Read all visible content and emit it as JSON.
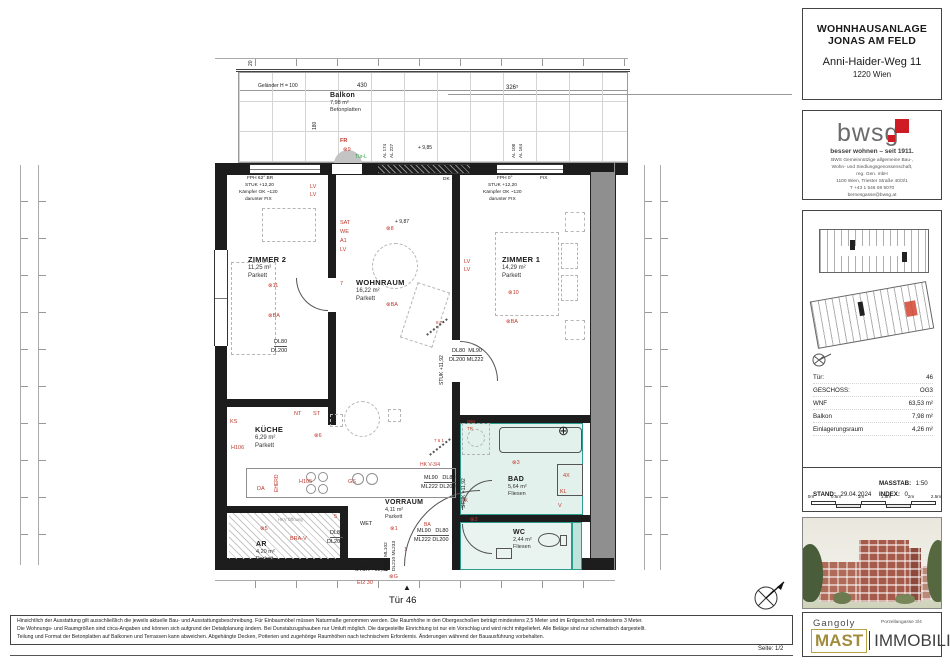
{
  "sheet_title": "Wohnungsplan Tür 46",
  "sidebar": {
    "header": {
      "line1": "WOHNHAUSANLAGE",
      "line2": "JONAS AM FELD",
      "street": "Anni-Haider-Weg 11",
      "city": "1220 Wien"
    },
    "bwsg": {
      "logo_text": "bwsg",
      "tagline": "besser wohnen – seit 1911.",
      "address_lines": [
        "BWS Gemeinnützige allgemeine Bau-,",
        "Wohn- und Siedlungsgenossenschaft,",
        "reg. Gen. mbH",
        "1100 Wien, Triester Straße 40/3/1",
        "T +43 1 546 08 5070",
        "bernesgasse@bwsg.at"
      ]
    },
    "info_table": {
      "rows": [
        {
          "label": "Tür:",
          "value": "46"
        },
        {
          "label": "GESCHOSS:",
          "value": "OG3"
        },
        {
          "label": "WNF",
          "value": "63,53 m²"
        },
        {
          "label": "Balkon",
          "value": "7,98 m²"
        },
        {
          "label": "Einlagerungsraum",
          "value": "4,26 m²"
        }
      ]
    },
    "meta": {
      "masstab_label": "MASSTAB:",
      "masstab_value": "1:50",
      "stand_label": "STAND:",
      "stand_value": "29.04.2024",
      "index_label": "INDEX:",
      "index_value": "0"
    },
    "scalebar": {
      "labels": [
        "0m",
        "0.5m",
        "1m",
        "1.5m",
        "2m",
        "2.5m"
      ]
    },
    "brand": {
      "architect": "Gangoly",
      "address": "Porzellangasse 3/4",
      "mast": "MAST",
      "immobilien": "IMMOBILIEN"
    }
  },
  "footer": {
    "page_label": "Seite: 1/2",
    "disclaimer_lines": [
      "Hinsichtlich der Ausstattung gilt ausschließlich die jeweils aktuelle Bau- und Ausstattungsbeschreibung. Für Einbaumöbel müssen Naturmaße genommen werden. Die Raumhöhe in den Obergeschoßen beträgt mindestens 2,5 Meter und im Erdgeschoß mindestens 3 Meter.",
      "Die Wohnungs- und Raumgrößen sind circa-Angaben und können sich aufgrund der Detailplanung ändern. Bei Dunstabzugshauben nur Umluft möglich. Die dargestellte Einrichtung ist nur ein Vorschlag und wird nicht mitgeliefert. Alle Beläge sind nur schematisch dargestellt.",
      "Teilung und Format der Betonplatten auf Balkonen und Terrassen kann abweichen. Abgehängte Decken, Potterien und zugehörige Raumhöhen nach technischem Erfordernis. Änderungen während der Bauausführung vorbehalten."
    ]
  },
  "plan": {
    "door_label": "Tür 46",
    "colors": {
      "red": "#c0392b",
      "green": "#2f9e44",
      "black": "#1a1a1a",
      "gray": "#8a8a8a",
      "bad_fill": "#e3f1ed",
      "bad_border": "#2e9c8c"
    },
    "rooms": {
      "balkon": {
        "name": "Balkon",
        "area": "7,98 m²",
        "floor": "Betonplatten"
      },
      "zimmer2": {
        "name": "ZIMMER 2",
        "area": "11,25 m²",
        "floor": "Parkett"
      },
      "wohnraum": {
        "name": "WOHNRAUM",
        "area": "16,22 m²",
        "floor": "Parkett"
      },
      "zimmer1": {
        "name": "ZIMMER 1",
        "area": "14,29 m²",
        "floor": "Parkett"
      },
      "kueche": {
        "name": "KÜCHE",
        "area": "6,29 m²",
        "floor": "Parkett"
      },
      "bad": {
        "name": "BAD",
        "area": "5,64 m²",
        "floor": "Fliesen"
      },
      "wc": {
        "name": "WC",
        "area": "2,44 m²",
        "floor": "Fliesen"
      },
      "vorraum": {
        "name": "VORRAUM",
        "area": "4,11 m²",
        "floor": "Parkett"
      },
      "ar": {
        "name": "AR",
        "area": "4,20 m²",
        "floor": "Parkett"
      }
    },
    "annotations": [
      {
        "t": "Geländer H = 100",
        "x": 258,
        "y": 84,
        "s": 5
      },
      {
        "t": "430",
        "x": 357,
        "y": 83,
        "s": 6
      },
      {
        "t": "326⁵",
        "x": 506,
        "y": 85,
        "s": 6
      },
      {
        "t": "20",
        "x": 249,
        "y": 66,
        "r": -90,
        "s": 5
      },
      {
        "t": "180",
        "x": 313,
        "y": 130,
        "r": -90,
        "s": 5
      },
      {
        "t": "+ 9,85",
        "x": 418,
        "y": 146,
        "s": 5
      },
      {
        "t": "+ 9,87",
        "x": 395,
        "y": 220,
        "s": 5
      },
      {
        "t": "AL 174",
        "x": 383,
        "y": 158,
        "r": -90,
        "s": 4.5
      },
      {
        "t": "AL 227",
        "x": 390,
        "y": 158,
        "r": -90,
        "s": 4.5
      },
      {
        "t": "AL 108",
        "x": 512,
        "y": 158,
        "r": -90,
        "s": 4.5
      },
      {
        "t": "AL 164",
        "x": 519,
        "y": 158,
        "r": -90,
        "s": 4.5
      },
      {
        "t": "FPH 62° BR",
        "x": 247,
        "y": 177,
        "s": 4.8
      },
      {
        "t": "STUK +12,20",
        "x": 245,
        "y": 184,
        "s": 4.8
      },
      {
        "t": "Kämpfer OK ~120",
        "x": 239,
        "y": 191,
        "s": 4.8
      },
      {
        "t": "darunter FIX",
        "x": 245,
        "y": 198,
        "s": 4.8
      },
      {
        "t": "DK",
        "x": 443,
        "y": 178,
        "s": 4.8
      },
      {
        "t": "FPH 0°",
        "x": 497,
        "y": 177,
        "s": 4.8
      },
      {
        "t": "FIX",
        "x": 540,
        "y": 177,
        "s": 4.8
      },
      {
        "t": "STUK +12,20",
        "x": 488,
        "y": 184,
        "s": 4.8
      },
      {
        "t": "Kämpfer OK ~120",
        "x": 483,
        "y": 191,
        "s": 4.8
      },
      {
        "t": "darunter FIX",
        "x": 489,
        "y": 198,
        "s": 4.8
      },
      {
        "t": "DL80",
        "x": 274,
        "y": 340,
        "s": 5.5,
        "u": 1
      },
      {
        "t": "DL200",
        "x": 271,
        "y": 349,
        "s": 5.5
      },
      {
        "t": "DL80  ML90",
        "x": 452,
        "y": 349,
        "s": 5.5,
        "u": 1
      },
      {
        "t": "DL200 ML222",
        "x": 449,
        "y": 358,
        "s": 5.5
      },
      {
        "t": "ML90   DL80",
        "x": 424,
        "y": 476,
        "s": 5.5,
        "u": 1
      },
      {
        "t": "ML222 DL200",
        "x": 421,
        "y": 485,
        "s": 5.5
      },
      {
        "t": "ML90   DL80",
        "x": 417,
        "y": 529,
        "s": 5.5,
        "u": 1
      },
      {
        "t": "ML222 DL200",
        "x": 414,
        "y": 538,
        "s": 5.5
      },
      {
        "t": "DL80",
        "x": 330,
        "y": 531,
        "s": 5.5,
        "u": 1
      },
      {
        "t": "DL200",
        "x": 327,
        "y": 540,
        "s": 5.5
      },
      {
        "t": "WET",
        "x": 360,
        "y": 522,
        "s": 5.5
      },
      {
        "t": "HKV Öffnung",
        "x": 278,
        "y": 518,
        "s": 4.2,
        "c": "gray"
      },
      {
        "t": "STUK +11,92",
        "x": 440,
        "y": 385,
        "r": -90,
        "s": 5
      },
      {
        "t": "STUK +11,92",
        "x": 462,
        "y": 508,
        "r": -90,
        "s": 5
      },
      {
        "t": "STUK +12,03",
        "x": 355,
        "y": 568,
        "s": 5.5
      },
      {
        "t": "DL90  ML102",
        "x": 385,
        "y": 571,
        "r": -90,
        "s": 4.8
      },
      {
        "t": "DL210 ML233",
        "x": 393,
        "y": 571,
        "r": -90,
        "s": 4.8
      },
      {
        "t": "▲",
        "x": 403,
        "y": 584,
        "s": 8
      },
      {
        "t": "⊕",
        "x": 558,
        "y": 424,
        "s": 13
      },
      {
        "t": "FR",
        "x": 340,
        "y": 139,
        "c": "red",
        "s": 5.5,
        "w": 1
      },
      {
        "t": "⊗9",
        "x": 343,
        "y": 148,
        "c": "red",
        "s": 5.5
      },
      {
        "t": "Tür-L",
        "x": 355,
        "y": 155,
        "c": "green",
        "s": 5
      },
      {
        "t": "LV",
        "x": 310,
        "y": 185,
        "c": "red",
        "s": 5.5
      },
      {
        "t": "LV",
        "x": 310,
        "y": 193,
        "c": "red",
        "s": 5.5
      },
      {
        "t": "SAT",
        "x": 340,
        "y": 221,
        "c": "red",
        "s": 5.5
      },
      {
        "t": "WE",
        "x": 340,
        "y": 230,
        "c": "red",
        "s": 5.5
      },
      {
        "t": "A1",
        "x": 340,
        "y": 239,
        "c": "red",
        "s": 5.5
      },
      {
        "t": "LV",
        "x": 340,
        "y": 248,
        "c": "red",
        "s": 5.5
      },
      {
        "t": "⊗11",
        "x": 268,
        "y": 284,
        "c": "red",
        "s": 5.5
      },
      {
        "t": "⊗BA",
        "x": 268,
        "y": 314,
        "c": "red",
        "s": 5.5
      },
      {
        "t": "7",
        "x": 340,
        "y": 282,
        "c": "red",
        "s": 5.5
      },
      {
        "t": "⊗8",
        "x": 386,
        "y": 227,
        "c": "red",
        "s": 5.5
      },
      {
        "t": "⊗BA",
        "x": 386,
        "y": 303,
        "c": "red",
        "s": 5.5
      },
      {
        "t": "LV",
        "x": 464,
        "y": 260,
        "c": "red",
        "s": 5.5
      },
      {
        "t": "LV",
        "x": 464,
        "y": 268,
        "c": "red",
        "s": 5.5
      },
      {
        "t": "⊗10",
        "x": 508,
        "y": 291,
        "c": "red",
        "s": 5.5
      },
      {
        "t": "⊗BA",
        "x": 506,
        "y": 320,
        "c": "red",
        "s": 5.5
      },
      {
        "t": "NT",
        "x": 294,
        "y": 412,
        "c": "red",
        "s": 5.5
      },
      {
        "t": "ST",
        "x": 313,
        "y": 412,
        "c": "red",
        "s": 5.5
      },
      {
        "t": "KS",
        "x": 230,
        "y": 420,
        "c": "red",
        "s": 5.5
      },
      {
        "t": "H106",
        "x": 231,
        "y": 446,
        "c": "red",
        "s": 5.5
      },
      {
        "t": "EHERD",
        "x": 275,
        "y": 492,
        "r": -90,
        "c": "red",
        "s": 5
      },
      {
        "t": "DA",
        "x": 257,
        "y": 487,
        "c": "red",
        "s": 5.5
      },
      {
        "t": "H105",
        "x": 299,
        "y": 480,
        "c": "red",
        "s": 5.5
      },
      {
        "t": "GS",
        "x": 348,
        "y": 480,
        "c": "red",
        "s": 5.5
      },
      {
        "t": "⊗6",
        "x": 314,
        "y": 434,
        "c": "red",
        "s": 5.5
      },
      {
        "t": "BRA-V",
        "x": 290,
        "y": 537,
        "c": "red",
        "s": 5.5
      },
      {
        "t": "⊗5",
        "x": 260,
        "y": 527,
        "c": "red",
        "s": 5.5
      },
      {
        "t": "5",
        "x": 334,
        "y": 515,
        "c": "red",
        "s": 5.5
      },
      {
        "t": "HK V-3/4",
        "x": 420,
        "y": 463,
        "c": "red",
        "s": 5
      },
      {
        "t": "7 6 1",
        "x": 434,
        "y": 439,
        "c": "red",
        "s": 4.5
      },
      {
        "t": "8 7",
        "x": 436,
        "y": 321,
        "c": "red",
        "s": 4.5
      },
      {
        "t": "WM",
        "x": 467,
        "y": 420,
        "c": "red",
        "s": 4.5
      },
      {
        "t": "TR",
        "x": 467,
        "y": 427,
        "c": "red",
        "s": 4.5
      },
      {
        "t": "⊗3",
        "x": 512,
        "y": 461,
        "c": "red",
        "s": 5.5
      },
      {
        "t": "4X",
        "x": 563,
        "y": 474,
        "c": "red",
        "s": 5.5
      },
      {
        "t": "KL",
        "x": 560,
        "y": 490,
        "c": "red",
        "s": 5.5
      },
      {
        "t": "V",
        "x": 558,
        "y": 504,
        "c": "red",
        "s": 5.5
      },
      {
        "t": "⊗2",
        "x": 470,
        "y": 518,
        "c": "red",
        "s": 5.5
      },
      {
        "t": "⊗1",
        "x": 390,
        "y": 527,
        "c": "red",
        "s": 5.5
      },
      {
        "t": "BA",
        "x": 424,
        "y": 523,
        "c": "red",
        "s": 5
      },
      {
        "t": "1",
        "x": 404,
        "y": 548,
        "c": "red",
        "s": 5.5
      },
      {
        "t": "HK",
        "x": 461,
        "y": 499,
        "c": "red",
        "s": 5
      },
      {
        "t": "⊗G",
        "x": 389,
        "y": 575,
        "c": "red",
        "s": 5.5
      },
      {
        "t": "EI2 30",
        "x": 357,
        "y": 581,
        "c": "red",
        "s": 5.5
      }
    ]
  }
}
